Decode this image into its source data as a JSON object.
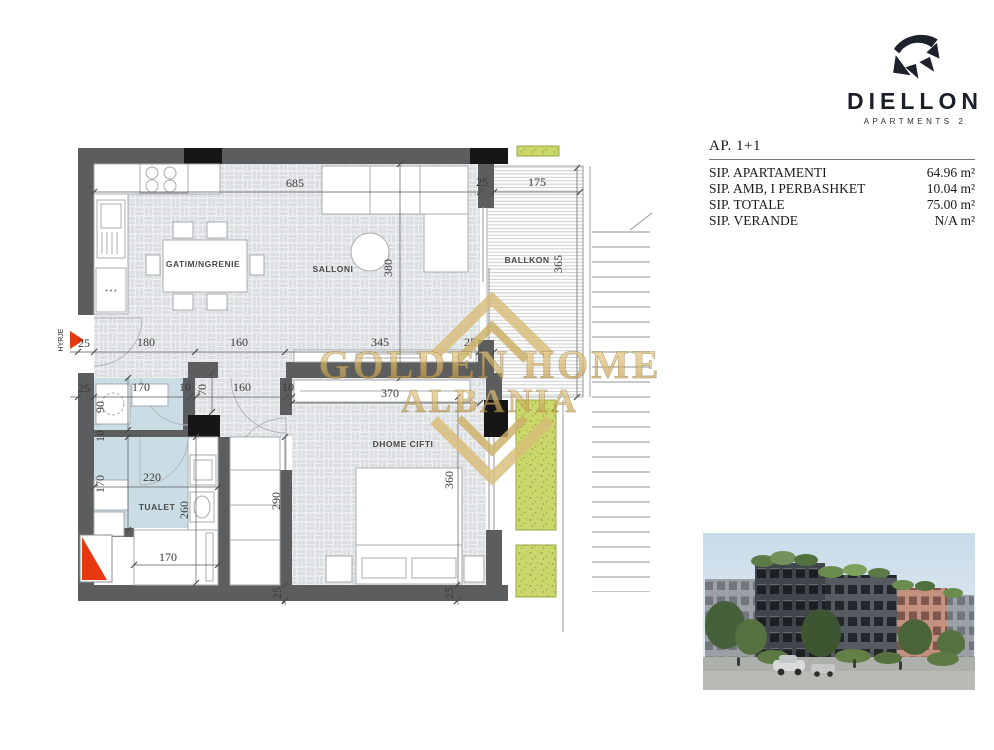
{
  "brand": {
    "name": "DIELLON",
    "tagline": "APARTMENTS 2"
  },
  "unit_info": {
    "title": "AP. 1+1",
    "rows": [
      {
        "label": "SIP. APARTAMENTI",
        "value": "64.96 m²"
      },
      {
        "label": "SIP. AMB, I PERBASHKET",
        "value": "10.04 m²"
      },
      {
        "label": "SIP. TOTALE",
        "value": "75.00 m²"
      },
      {
        "label": "SIP. VERANDE",
        "value": "N/A m²"
      }
    ]
  },
  "floor_plan": {
    "entrance_label": "HYRJE",
    "rooms": [
      {
        "id": "kitchen-dining",
        "label": "GATIM/NGRENIE",
        "x": 203,
        "y": 267
      },
      {
        "id": "living-room",
        "label": "SALLONI",
        "x": 333,
        "y": 272
      },
      {
        "id": "balcony",
        "label": "BALLKON",
        "x": 527,
        "y": 263
      },
      {
        "id": "bedroom",
        "label": "DHOME CIFTI",
        "x": 403,
        "y": 447
      },
      {
        "id": "bathroom",
        "label": "TUALET",
        "x": 157,
        "y": 510
      }
    ],
    "dimensions": [
      {
        "t": "685",
        "x": 295,
        "y": 187,
        "r": 0
      },
      {
        "t": "25",
        "x": 482,
        "y": 186,
        "r": 0
      },
      {
        "t": "175",
        "x": 537,
        "y": 186,
        "r": 0
      },
      {
        "t": "380",
        "x": 392,
        "y": 268,
        "r": -90
      },
      {
        "t": "365",
        "x": 562,
        "y": 264,
        "r": -90
      },
      {
        "t": "25",
        "x": 84,
        "y": 347,
        "r": 0
      },
      {
        "t": "180",
        "x": 146,
        "y": 346,
        "r": 0
      },
      {
        "t": "160",
        "x": 239,
        "y": 346,
        "r": 0
      },
      {
        "t": "345",
        "x": 380,
        "y": 346,
        "r": 0
      },
      {
        "t": "25",
        "x": 470,
        "y": 346,
        "r": 0
      },
      {
        "t": "25",
        "x": 84,
        "y": 392,
        "r": 0
      },
      {
        "t": "170",
        "x": 141,
        "y": 391,
        "r": 0
      },
      {
        "t": "10",
        "x": 185,
        "y": 391,
        "r": 0
      },
      {
        "t": "70",
        "x": 206,
        "y": 390,
        "r": -90
      },
      {
        "t": "160",
        "x": 242,
        "y": 391,
        "r": 0
      },
      {
        "t": "10",
        "x": 288,
        "y": 391,
        "r": 0
      },
      {
        "t": "370",
        "x": 390,
        "y": 397,
        "r": 0
      },
      {
        "t": "90",
        "x": 104,
        "y": 407,
        "r": -90
      },
      {
        "t": "10",
        "x": 104,
        "y": 436,
        "r": -90
      },
      {
        "t": "170",
        "x": 104,
        "y": 484,
        "r": -90
      },
      {
        "t": "220",
        "x": 152,
        "y": 481,
        "r": 0
      },
      {
        "t": "260",
        "x": 188,
        "y": 510,
        "r": -90
      },
      {
        "t": "290",
        "x": 280,
        "y": 501,
        "r": -90
      },
      {
        "t": "360",
        "x": 453,
        "y": 480,
        "r": -90
      },
      {
        "t": "170",
        "x": 168,
        "y": 561,
        "r": 0
      },
      {
        "t": "25",
        "x": 281,
        "y": 593,
        "r": -90
      },
      {
        "t": "25",
        "x": 453,
        "y": 593,
        "r": -90
      }
    ]
  },
  "watermark": {
    "line1": "GOLDEN HOME",
    "line2": "ALBANIA"
  },
  "colors": {
    "wall": "#5b5d5f",
    "wall_black": "#161616",
    "accent_red": "#e6390f",
    "floor_tile": "#dcdfe1",
    "bath_floor": "#cadde5",
    "planter": "#cbd76a",
    "watermark_gold": "#d4b264"
  }
}
